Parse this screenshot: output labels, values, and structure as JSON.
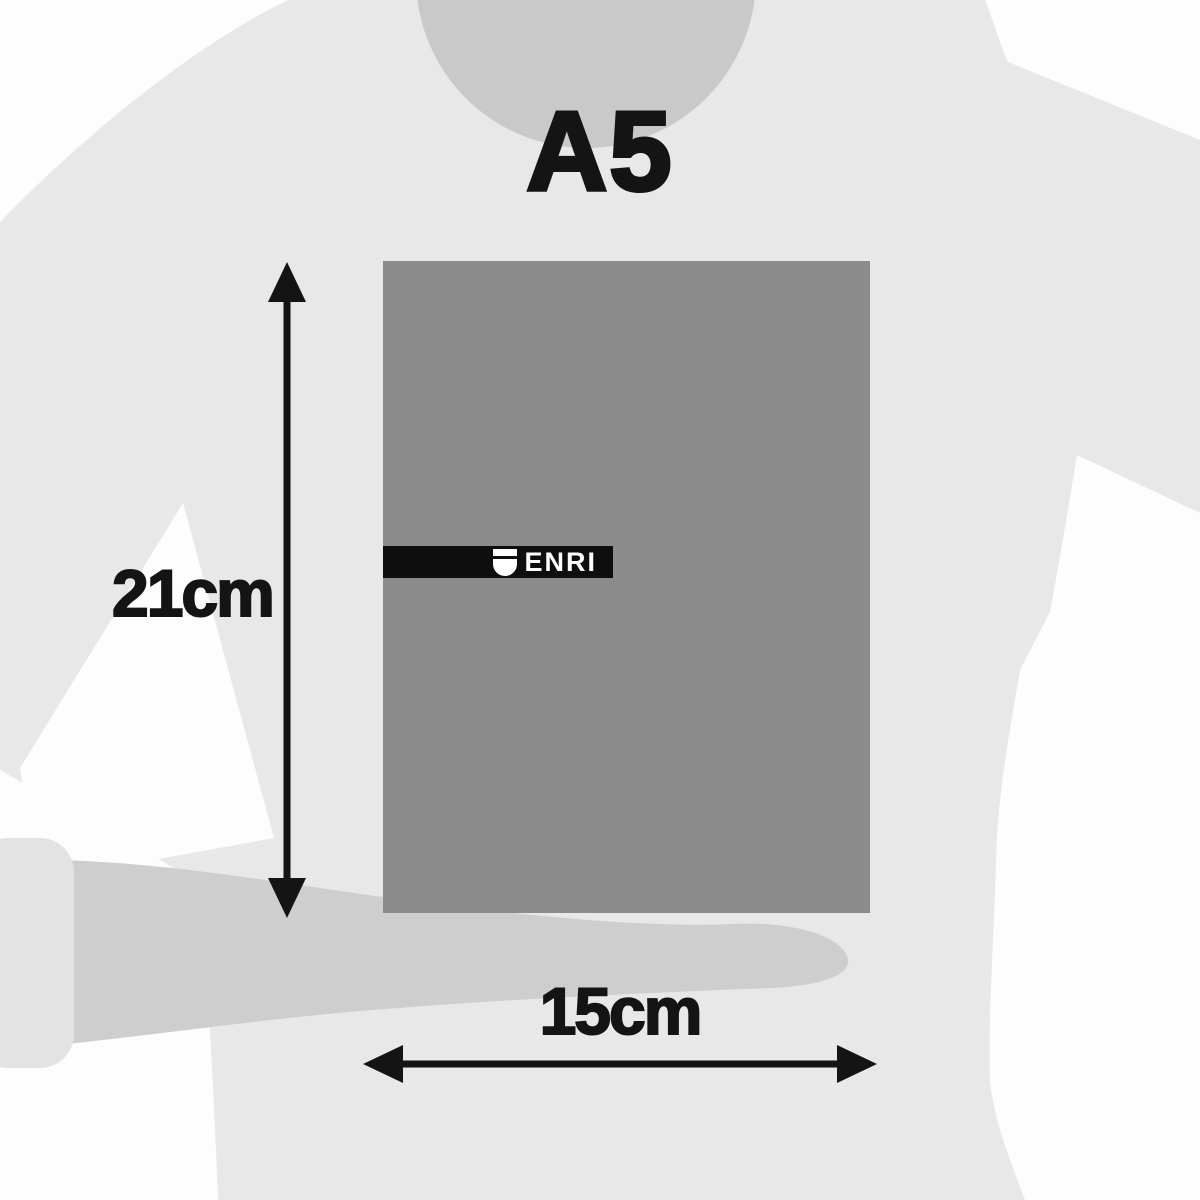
{
  "image": {
    "type": "product-dimension-diagram",
    "format_label": "A5"
  },
  "brand": {
    "name": "ENRI",
    "icon": "shield-icon"
  },
  "dimensions": {
    "height_label": "21cm",
    "width_label": "15cm"
  },
  "colors": {
    "background": "#fdfdfd",
    "shirt": "#e8e8e8",
    "neck": "#c9c9c9",
    "arm": "#cecece",
    "cuff": "#e3e3e3",
    "notebook": "#8b8b8b",
    "band": "#0e0e0e",
    "ink": "#141414",
    "brand-text": "#ffffff"
  }
}
